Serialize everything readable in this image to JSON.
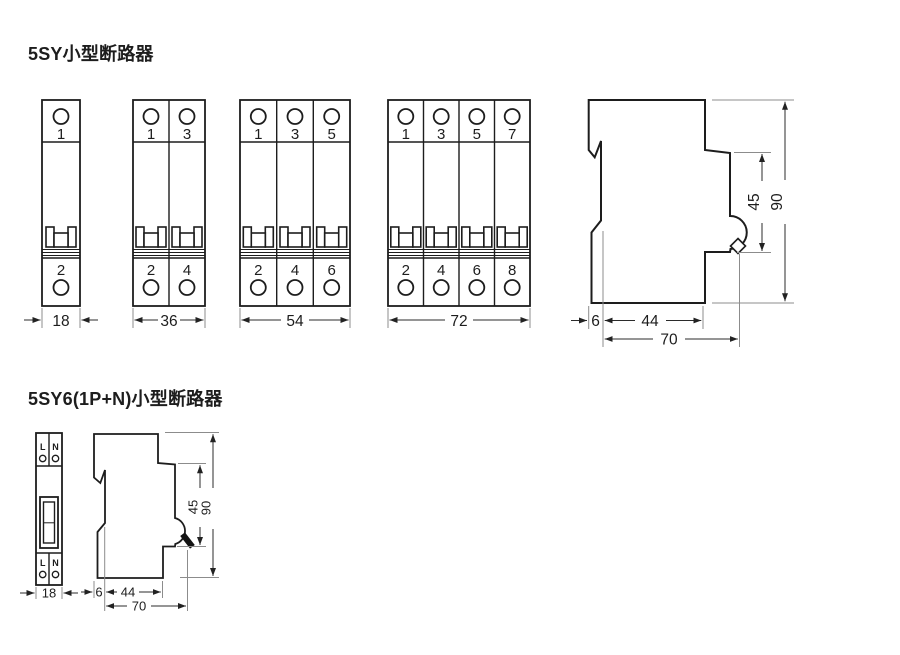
{
  "titles": {
    "section1": "5SY小型断路器",
    "section2": "5SY6(1P+N)小型断路器"
  },
  "front_views": {
    "unit1": {
      "top": [
        "1"
      ],
      "bottom": [
        "2"
      ],
      "width": "18"
    },
    "unit2": {
      "top": [
        "1",
        "3"
      ],
      "bottom": [
        "2",
        "4"
      ],
      "width": "36"
    },
    "unit3": {
      "top": [
        "1",
        "3",
        "5"
      ],
      "bottom": [
        "2",
        "4",
        "6"
      ],
      "width": "54"
    },
    "unit4": {
      "top": [
        "1",
        "3",
        "5",
        "7"
      ],
      "bottom": [
        "2",
        "4",
        "6",
        "8"
      ],
      "width": "72"
    }
  },
  "side_view": {
    "front_height": "45",
    "total_height": "90",
    "clip_depth": "6",
    "body_depth": "44",
    "total_depth": "70"
  },
  "np_view": {
    "front": {
      "left_terminal": "L",
      "right_terminal": "N",
      "width": "18"
    },
    "side": {
      "front_height": "45",
      "total_height": "90",
      "clip_depth": "6",
      "body_depth": "44",
      "total_depth": "70"
    }
  }
}
